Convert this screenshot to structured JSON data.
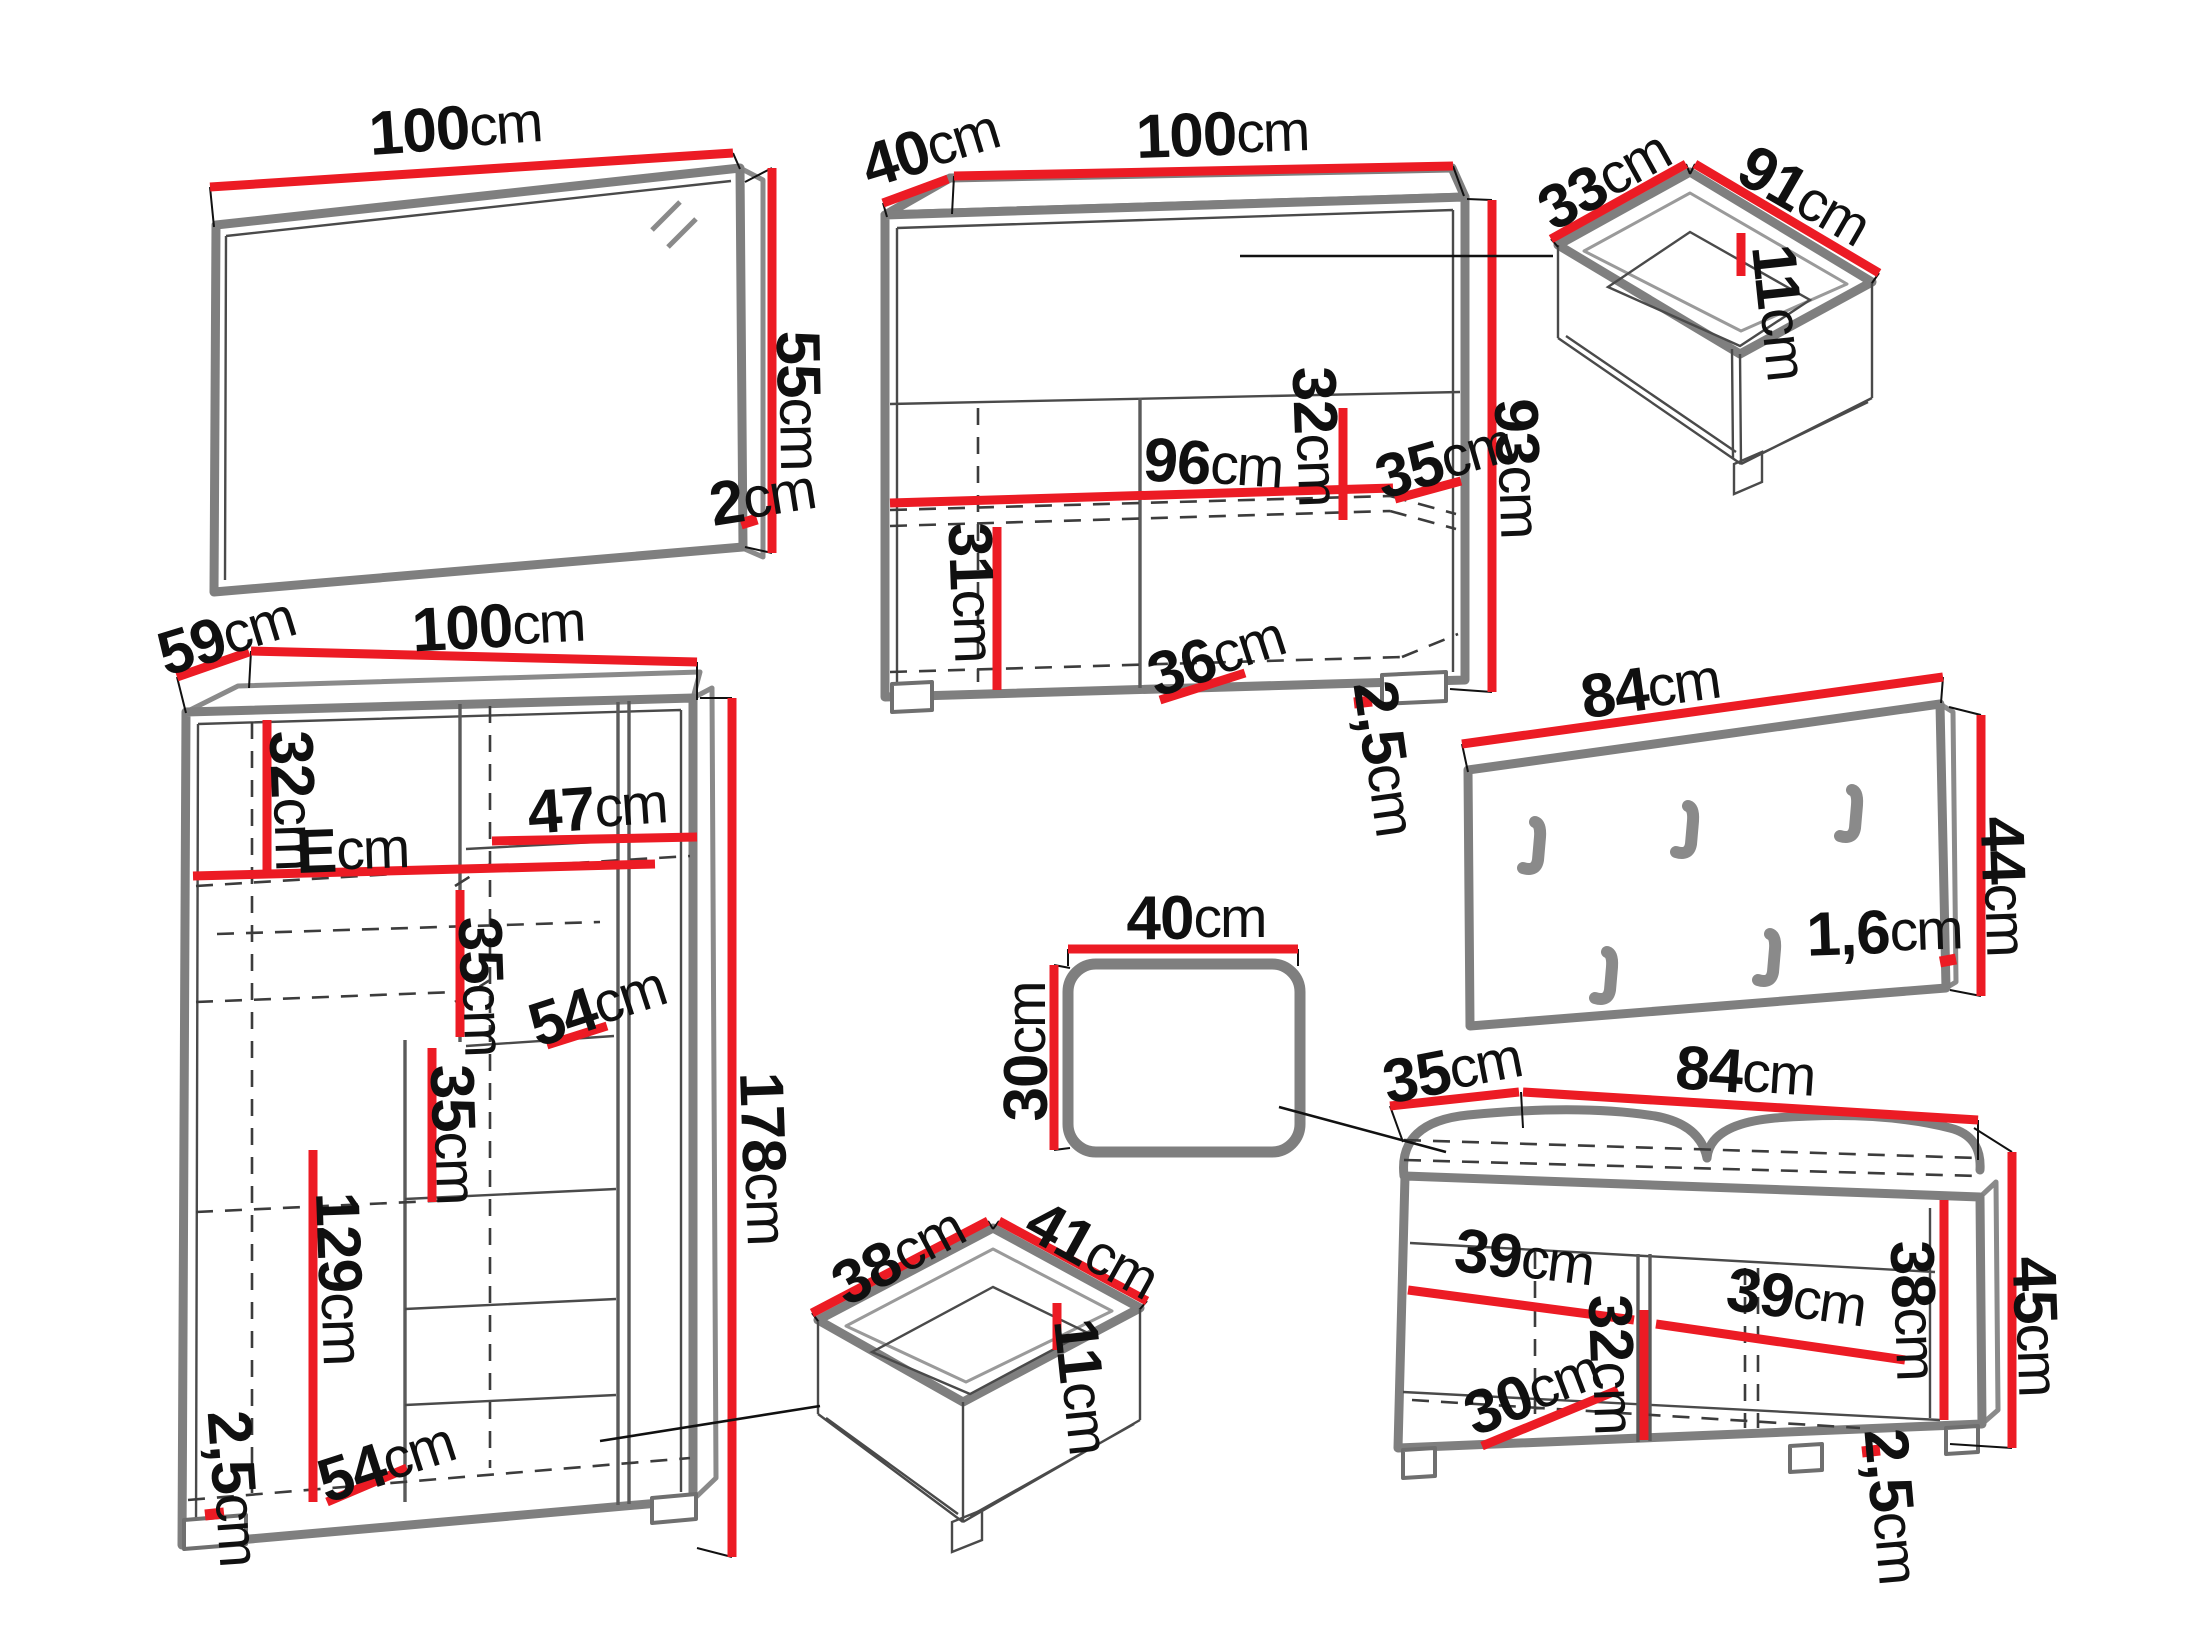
{
  "units": "cm",
  "colors": {
    "dimension_red": "#ec1b24",
    "furniture_gray": "#7f7f7f",
    "label_black": "#101010",
    "background": "#ffffff"
  },
  "pieces": {
    "mirror": {
      "width": "100",
      "height": "55",
      "thickness": "2"
    },
    "sideboard": {
      "width": "100",
      "depth": "40",
      "height": "93",
      "inner_width": "96",
      "upper_inner_height": "32",
      "lower_inner_height": "31",
      "inner_depth_front": "36",
      "inner_depth_side": "35",
      "plinth_height": "2,5"
    },
    "drawer_large": {
      "depth": "33",
      "width": "91",
      "height": "11"
    },
    "wardrobe": {
      "depth": "59",
      "width": "100",
      "height": "178",
      "upper_section_height": "32",
      "upper_shelf_width": "E",
      "shelf_width": "47",
      "shelf_spacing_upper": "35",
      "shelf_spacing_lower": "35",
      "shelf_depth": "54",
      "hanging_height": "129",
      "bottom_shelf_width": "54",
      "plinth_height": "2,5"
    },
    "coat_rack": {
      "width": "84",
      "height": "44",
      "thickness": "1,6",
      "hook_count": 5
    },
    "seat_cushion": {
      "width": "40",
      "depth": "30"
    },
    "drawer_small": {
      "depth": "38",
      "width": "41",
      "height": "11"
    },
    "bench": {
      "depth": "35",
      "width": "84",
      "height": "45",
      "left_compartment_width": "39",
      "right_compartment_width": "39",
      "left_inner_height": "32",
      "right_inner_height": "38",
      "inner_depth": "30",
      "plinth_height": "2,5"
    }
  }
}
